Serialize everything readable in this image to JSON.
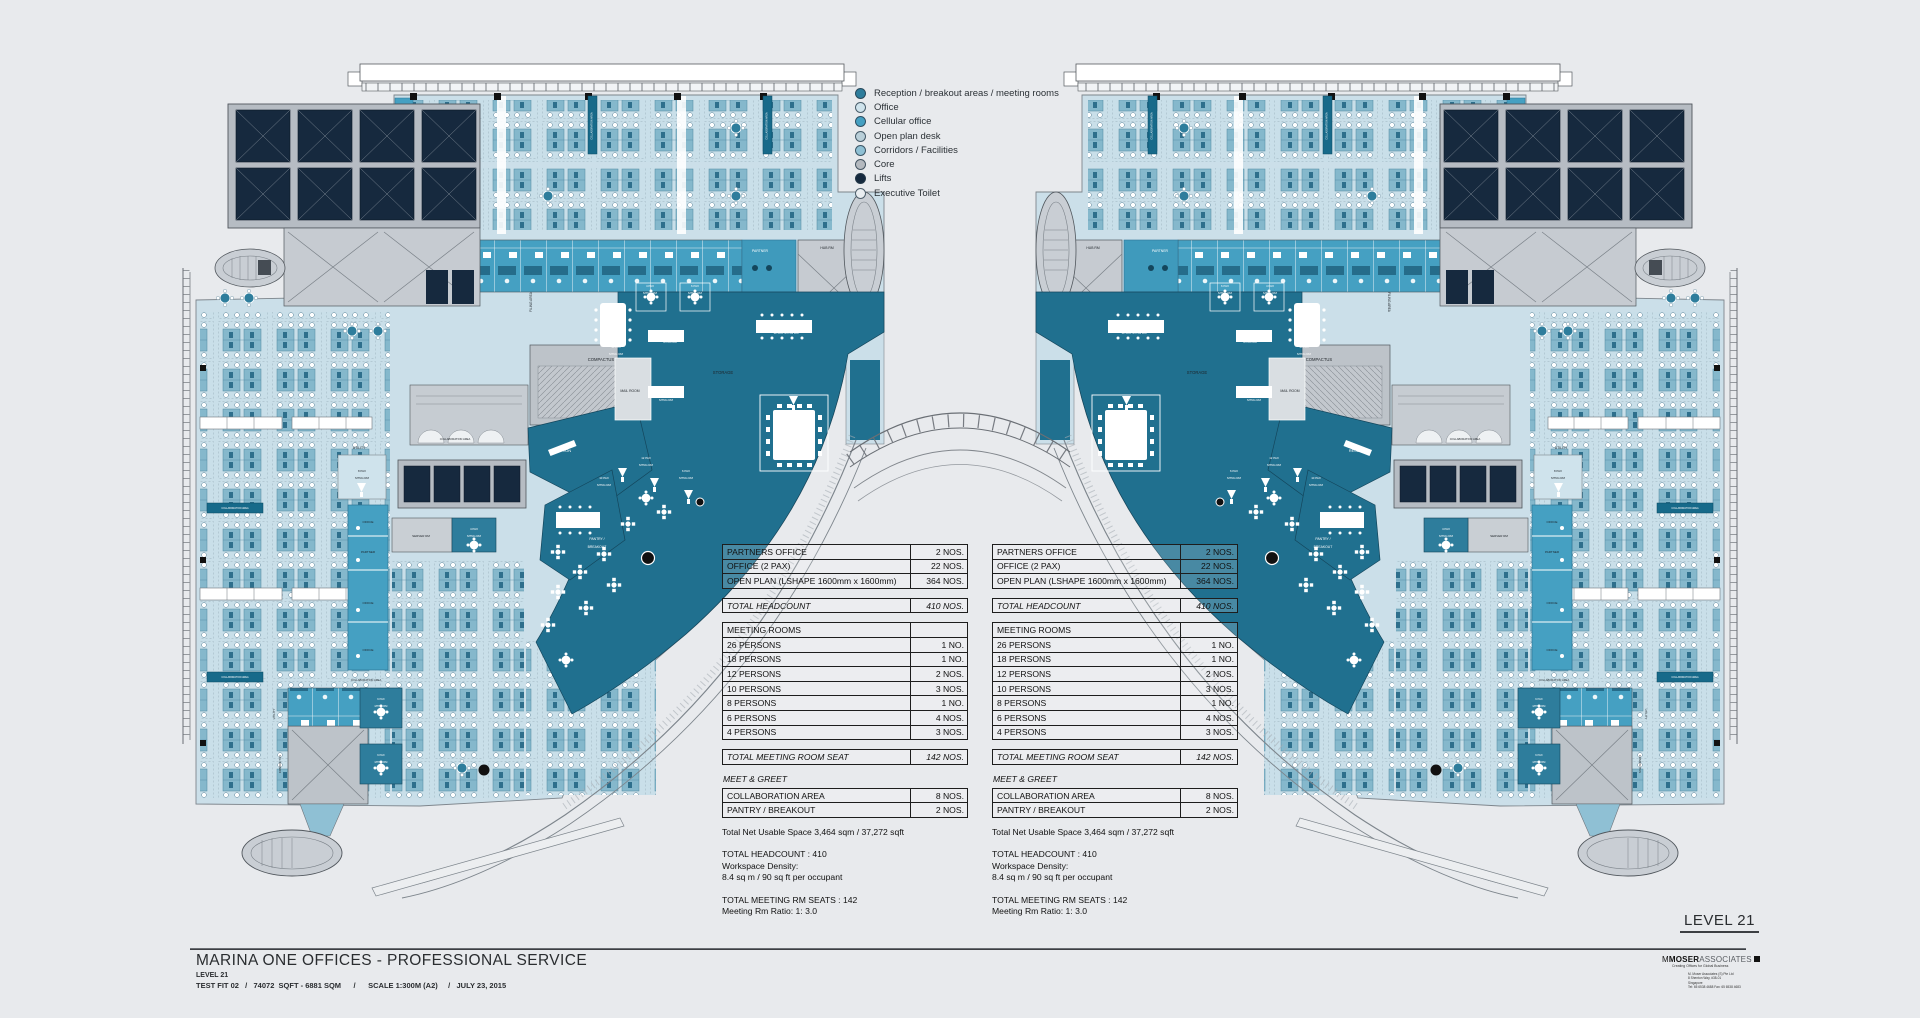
{
  "drawing": {
    "project_title": "MARINA ONE OFFICES - PROFESSIONAL SERVICE",
    "level": "LEVEL 21",
    "details": "TEST FIT 02   /   74072  SQFT - 6881 SQM      /      SCALE 1:300M (A2)     /   JULY 23, 2015",
    "level_badge": "LEVEL 21"
  },
  "legend": {
    "items": [
      {
        "label": "Reception / breakout areas / meeting rooms",
        "color": "#2e7d9c"
      },
      {
        "label": "Office",
        "color": "#cfe3ec"
      },
      {
        "label": "Cellular office",
        "color": "#45a0c2"
      },
      {
        "label": "Open plan desk",
        "color": "#b9cfd9"
      },
      {
        "label": "Corridors / Facilities",
        "color": "#8fc0d4"
      },
      {
        "label": "Core",
        "color": "#b4b9bf"
      },
      {
        "label": "Lifts",
        "color": "#15293e"
      },
      {
        "label": "Executive Toilet",
        "color": "#e9edf0"
      }
    ]
  },
  "stat_table": {
    "sections": [
      {
        "rows": [
          [
            "PARTNERS OFFICE",
            "2 NOS."
          ],
          [
            "OFFICE (2 PAX)",
            "22 NOS."
          ],
          [
            "OPEN PLAN  (LSHAPE 1600mm x 1600mm)",
            "364 NOS."
          ]
        ]
      },
      {
        "italic": true,
        "rows": [
          [
            "TOTAL HEADCOUNT",
            "410 NOS."
          ]
        ]
      },
      {
        "rows": [
          [
            "MEETING ROOMS",
            ""
          ],
          [
            "26 PERSONS",
            "1 NO."
          ],
          [
            "18 PERSONS",
            "1 NO."
          ],
          [
            "12 PERSONS",
            "2 NOS."
          ],
          [
            "10 PERSONS",
            "3 NOS."
          ],
          [
            "8 PERSONS",
            "1 NO."
          ],
          [
            "6 PERSONS",
            "4 NOS."
          ],
          [
            "4 PERSONS",
            "3 NOS."
          ]
        ]
      },
      {
        "italic": true,
        "rows": [
          [
            "TOTAL MEETING ROOM SEAT",
            "142 NOS."
          ]
        ]
      },
      {
        "heading": "MEET  & GREET",
        "rows": [
          [
            "COLLABORATION AREA",
            "8 NOS."
          ],
          [
            "PANTRY / BREAKOUT",
            "2 NOS."
          ]
        ]
      }
    ],
    "notes": [
      {
        "text": "Total Net Usable Space 3,464 sqm / 37,272 sqft",
        "gap": true
      },
      {
        "text": "TOTAL HEADCOUNT : 410"
      },
      {
        "text": "Workspace Density:"
      },
      {
        "text": "8.4 sq m /  90 sq ft per occupant",
        "gap": true
      },
      {
        "text": "TOTAL MEETING RM SEATS : 142"
      },
      {
        "text": "Meeting Rm Ratio: 1: 3.0"
      }
    ]
  },
  "logo": {
    "m": "M",
    "bold": "MOSER",
    "rest": "ASSOCIATES",
    "tagline": "Creating Offices for Global Business",
    "address": [
      "M. Moser Associates (S) Pte Ltd",
      "8 Shenton Way, #38-01",
      "Singapore",
      "Tel: 65 6538 4688  Fax: 65 6538 4683"
    ]
  },
  "plan": {
    "banner_text": "COLLABORATION AREA",
    "banners": [
      {
        "x": 207,
        "y": 503,
        "w": 56,
        "h": 10
      },
      {
        "x": 207,
        "y": 672,
        "w": 56,
        "h": 10
      },
      {
        "x": 588,
        "y": 96,
        "w": 9,
        "h": 58,
        "v": 1
      },
      {
        "x": 763,
        "y": 96,
        "w": 9,
        "h": 58,
        "v": 1
      }
    ],
    "labels": [
      {
        "t": "COMPACTUS",
        "x": 601,
        "y": 361,
        "s": 4.2,
        "c": "d"
      },
      {
        "t": "STORAGE",
        "x": 723,
        "y": 374,
        "s": 4.2,
        "c": "d"
      },
      {
        "t": "PARTNER",
        "x": 760,
        "y": 252,
        "s": 3.4,
        "c": "w"
      },
      {
        "t": "HUB RM",
        "x": 827,
        "y": 249,
        "s": 3.4,
        "c": "d"
      },
      {
        "t": "FILING AREA",
        "x": 532,
        "y": 302,
        "s": 3.2,
        "c": "d",
        "r": -90
      },
      {
        "t": "4 PAX",
        "x": 650,
        "y": 287,
        "s": 2.9,
        "c": "w"
      },
      {
        "t": "MTNG RM",
        "x": 650,
        "y": 294,
        "s": 2.9,
        "c": "w"
      },
      {
        "t": "6 PAX",
        "x": 695,
        "y": 287,
        "s": 2.9,
        "c": "w"
      },
      {
        "t": "MTNG RM",
        "x": 695,
        "y": 294,
        "s": 2.9,
        "c": "w"
      },
      {
        "t": "18 PAX",
        "x": 616,
        "y": 348,
        "s": 2.9,
        "c": "w"
      },
      {
        "t": "MTNG RM",
        "x": 616,
        "y": 355,
        "s": 2.9,
        "c": "w"
      },
      {
        "t": "10 PAX",
        "x": 670,
        "y": 336,
        "s": 2.9,
        "c": "w"
      },
      {
        "t": "MTNG RM",
        "x": 670,
        "y": 343,
        "s": 2.9,
        "c": "w"
      },
      {
        "t": "10 PAX",
        "x": 666,
        "y": 394,
        "s": 2.9,
        "c": "w"
      },
      {
        "t": "MTNG RM",
        "x": 666,
        "y": 401,
        "s": 2.9,
        "c": "w"
      },
      {
        "t": "12 PAX MTNG RM",
        "x": 786,
        "y": 334,
        "s": 3,
        "c": "w"
      },
      {
        "t": "26 PAX",
        "x": 796,
        "y": 428,
        "s": 3.2,
        "c": "w"
      },
      {
        "t": "BOARDROOM",
        "x": 796,
        "y": 436,
        "s": 3.2,
        "c": "w"
      },
      {
        "t": "MAIL ROOM",
        "x": 630,
        "y": 392,
        "s": 3.4,
        "c": "d"
      },
      {
        "t": "RECEPTION",
        "x": 560,
        "y": 452,
        "s": 3.8,
        "c": "w"
      },
      {
        "t": "PANTRY /",
        "x": 597,
        "y": 540,
        "s": 3.4,
        "c": "w"
      },
      {
        "t": "BREAKOUT",
        "x": 597,
        "y": 548,
        "s": 3.4,
        "c": "w"
      },
      {
        "t": "10 PAX",
        "x": 604,
        "y": 479,
        "s": 2.9,
        "c": "w"
      },
      {
        "t": "MTNG RM",
        "x": 604,
        "y": 486,
        "s": 2.9,
        "c": "w"
      },
      {
        "t": "12 PAX",
        "x": 646,
        "y": 459,
        "s": 2.9,
        "c": "w"
      },
      {
        "t": "MTNG RM",
        "x": 646,
        "y": 466,
        "s": 2.9,
        "c": "w"
      },
      {
        "t": "6 PAX",
        "x": 686,
        "y": 472,
        "s": 2.9,
        "c": "w"
      },
      {
        "t": "MTNG RM",
        "x": 686,
        "y": 479,
        "s": 2.9,
        "c": "w"
      },
      {
        "t": "SERVER RM",
        "x": 421,
        "y": 537,
        "s": 3,
        "c": "d"
      },
      {
        "t": "4 PAX",
        "x": 474,
        "y": 530,
        "s": 2.9,
        "c": "w"
      },
      {
        "t": "MTNG RM",
        "x": 474,
        "y": 537,
        "s": 2.9,
        "c": "w"
      },
      {
        "t": "UTILITY",
        "x": 359,
        "y": 449,
        "s": 3.4,
        "c": "d"
      },
      {
        "t": "8 PAX",
        "x": 362,
        "y": 472,
        "s": 2.9,
        "c": "d"
      },
      {
        "t": "MTNG RM",
        "x": 362,
        "y": 479,
        "s": 2.9,
        "c": "d"
      },
      {
        "t": "OFFICE",
        "x": 368,
        "y": 523,
        "s": 3,
        "c": "d"
      },
      {
        "t": "PARTNER",
        "x": 368,
        "y": 553,
        "s": 3,
        "c": "d"
      },
      {
        "t": "OFFICE",
        "x": 368,
        "y": 604,
        "s": 3,
        "c": "d"
      },
      {
        "t": "OFFICE",
        "x": 368,
        "y": 651,
        "s": 3,
        "c": "d"
      },
      {
        "t": "6 PAX",
        "x": 381,
        "y": 700,
        "s": 2.7,
        "c": "w"
      },
      {
        "t": "MTNG RM",
        "x": 381,
        "y": 707,
        "s": 2.7,
        "c": "w"
      },
      {
        "t": "6 PAX",
        "x": 381,
        "y": 756,
        "s": 2.7,
        "c": "w"
      },
      {
        "t": "MTNG RM",
        "x": 381,
        "y": 763,
        "s": 2.7,
        "c": "w"
      },
      {
        "t": "COMPACTUS",
        "x": 281,
        "y": 764,
        "s": 2.9,
        "c": "d",
        "r": -90
      },
      {
        "t": "UTILITY",
        "x": 275,
        "y": 714,
        "s": 2.9,
        "c": "d",
        "r": -90
      },
      {
        "t": "COLLABORATION AREA",
        "x": 455,
        "y": 440,
        "s": 2.7,
        "c": "d"
      },
      {
        "t": "COLLABORATION AREA",
        "x": 366,
        "y": 681,
        "s": 2.7,
        "c": "d"
      }
    ]
  }
}
